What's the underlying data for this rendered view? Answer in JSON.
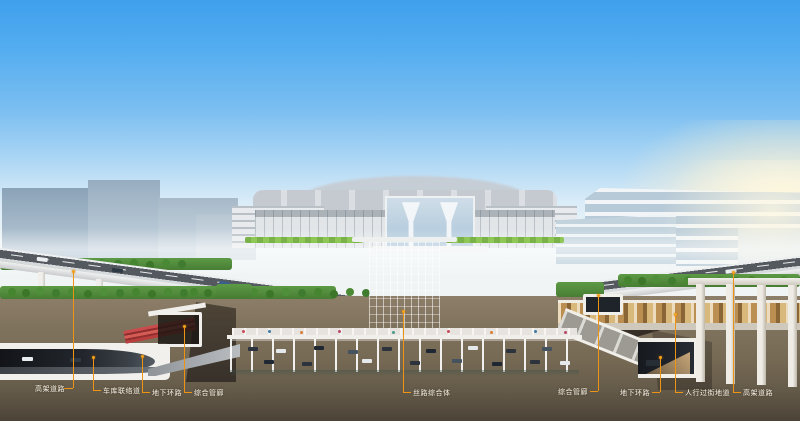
{
  "scene": {
    "kind": "architectural cutaway rendering of a rail transit hub with underground infrastructure annotations"
  },
  "colors": {
    "callout_accent": "#EE9414",
    "sky_top": "#3FA0EC",
    "sky_horizon": "#EFF5F7",
    "earth_brown": "#7B6E5A",
    "parking_teal": "#63BCB2",
    "green_roof": "#8FC757",
    "utility_pipes_red": "#C94B4B",
    "label_text": "#F6F3EC"
  },
  "callouts": [
    {
      "label": "高架道路"
    },
    {
      "label": "车库联络道"
    },
    {
      "label": "地下环路"
    },
    {
      "label": "综合管廊"
    },
    {
      "label": "丝路综合体"
    },
    {
      "label": "综合管廊"
    },
    {
      "label": "地下环路"
    },
    {
      "label": "人行过街地道"
    },
    {
      "label": "高架道路"
    }
  ]
}
